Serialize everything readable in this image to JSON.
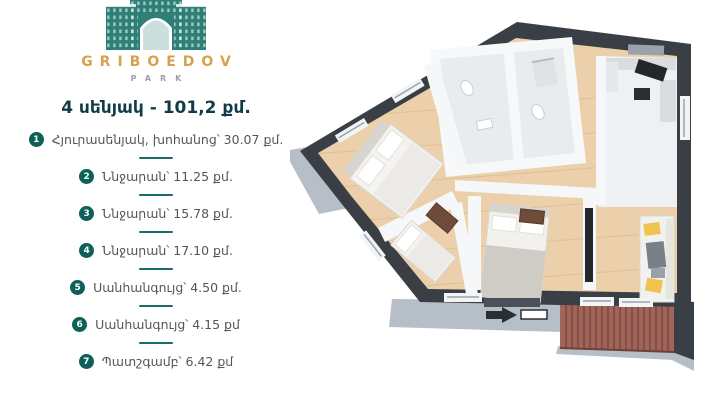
{
  "brand": {
    "name": "GRIBOEDOV",
    "subtitle": "PARK",
    "logo_icon": "arch-building-icon",
    "logo_color": "#2e8076",
    "name_color": "#d8a14b"
  },
  "header": {
    "title": "4 սենյակ - 101,2 քմ.",
    "title_color": "#113c47"
  },
  "room_list": {
    "items": [
      {
        "num": "1",
        "label": "Հյուրասենյակ, խոհանոց՝ 30.07 քմ."
      },
      {
        "num": "2",
        "label": "Ննջարան՝ 11.25 քմ."
      },
      {
        "num": "3",
        "label": "Ննջարան՝ 15.78 քմ."
      },
      {
        "num": "4",
        "label": "Ննջարան՝ 17.10 քմ."
      },
      {
        "num": "5",
        "label": "Սանհանգույց՝ 4.50 քմ."
      },
      {
        "num": "6",
        "label": "Սանհանգույց՝ 4.15 քմ"
      },
      {
        "num": "7",
        "label": "Պատշգամբ՝ 6.42 քմ"
      }
    ],
    "badge_color": "#0d6158",
    "divider_color": "#1b6b66",
    "text_color": "#54565a"
  },
  "floorplan": {
    "kind": "3d-apartment-floor-plan",
    "wall_color": "#3a3f45",
    "floor_color": "#ecd0ab",
    "ledge_color": "#b6bec8",
    "balcony_rail_color": "#a2655a",
    "sofa_pillow_color": "#f0c34f"
  }
}
